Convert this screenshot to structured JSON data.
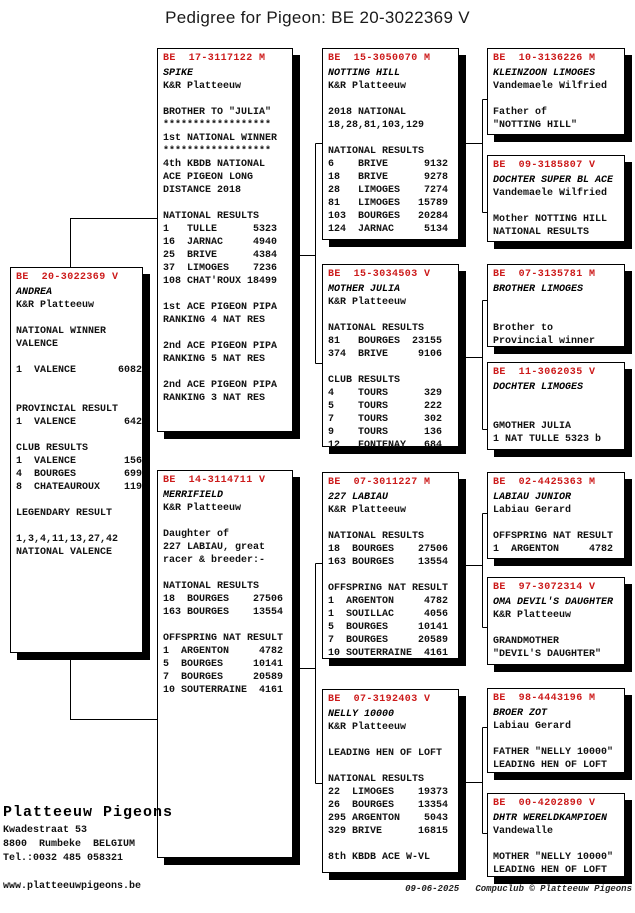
{
  "title": "Pedigree for Pigeon: BE  20-3022369 V",
  "colors": {
    "ring_red": "#cc1a1a",
    "line": "#000000",
    "shadow": "#000000"
  },
  "boxes": {
    "subject": {
      "ring": "BE  20-3022369 V",
      "name": "ANDREA",
      "body": "K&R Platteeuw\n\nNATIONAL WINNER\nVALENCE\n\n1  VALENCE       6082\n\n\nPROVINCIAL RESULT\n1  VALENCE        642\n\nCLUB RESULTS\n1  VALENCE        156\n4  BOURGES        699\n8  CHATEAUROUX    119\n\nLEGENDARY RESULT\n\n1,3,4,11,13,27,42\nNATIONAL VALENCE"
    },
    "sire": {
      "ring": "BE  17-3117122 M",
      "name": "SPIKE",
      "body": "K&R Platteeuw\n\nBROTHER TO \"JULIA\"\n******************\n1st NATIONAL WINNER\n******************\n4th KBDB NATIONAL\nACE PIGEON LONG\nDISTANCE 2018\n\nNATIONAL RESULTS\n1   TULLE      5323\n16  JARNAC     4940\n25  BRIVE      4384\n37  LIMOGES    7236\n108 CHAT'ROUX 18499\n\n1st ACE PIGEON PIPA\nRANKING 4 NAT RES\n\n2nd ACE PIGEON PIPA\nRANKING 5 NAT RES\n\n2nd ACE PIGEON PIPA\nRANKING 3 NAT RES"
    },
    "dam": {
      "ring": "BE  14-3114711 V",
      "name": "MERRIFIELD",
      "body": "K&R Platteeuw\n\nDaughter of\n227 LABIAU, great\nracer & breeder:-\n\nNATIONAL RESULTS\n18  BOURGES    27506\n163 BOURGES    13554\n\nOFFSPRING NAT RESULT\n1  ARGENTON     4782\n5  BOURGES     10141\n7  BOURGES     20589\n10 SOUTERRAINE  4161"
    },
    "ss": {
      "ring": "BE  15-3050070 M",
      "name": "NOTTING HILL",
      "body": "K&R Platteeuw\n\n2018 NATIONAL\n18,28,81,103,129\n\nNATIONAL RESULTS\n6    BRIVE      9132\n18   BRIVE      9278\n28   LIMOGES    7274\n81   LIMOGES   15789\n103  BOURGES   20284\n124  JARNAC     5134"
    },
    "sd": {
      "ring": "BE  15-3034503 V",
      "name": "MOTHER JULIA",
      "body": "K&R Platteeuw\n\nNATIONAL RESULTS\n81   BOURGES  23155\n374  BRIVE     9106\n\nCLUB RESULTS\n4    TOURS      329\n5    TOURS      222\n7    TOURS      302\n9    TOURS      136\n12   FONTENAY   684"
    },
    "ds": {
      "ring": "BE  07-3011227 M",
      "name": "227 LABIAU",
      "body": "K&R Platteeuw\n\nNATIONAL RESULTS\n18  BOURGES    27506\n163 BOURGES    13554\n\nOFFSPRING NAT RESULT\n1  ARGENTON     4782\n1  SOUILLAC     4056\n5  BOURGES     10141\n7  BOURGES     20589\n10 SOUTERRAINE  4161"
    },
    "dd": {
      "ring": "BE  07-3192403 V",
      "name": "NELLY 10000",
      "body": "K&R Platteeuw\n\nLEADING HEN OF LOFT\n\nNATIONAL RESULTS\n22  LIMOGES    19373\n26  BOURGES    13354\n295 ARGENTON    5043\n329 BRIVE      16815\n\n8th KBDB ACE W-VL"
    },
    "sss": {
      "ring": "BE  10-3136226 M",
      "name": "KLEINZOON LIMOGES",
      "body": "Vandemaele Wilfried\n\nFather of\n\"NOTTING HILL\""
    },
    "ssd": {
      "ring": "BE  09-3185807 V",
      "name": "DOCHTER SUPER BL ACE",
      "body": "Vandemaele Wilfried\n\nMother NOTTING HILL\nNATIONAL RESULTS"
    },
    "sds": {
      "ring": "BE  07-3135781 M",
      "name": "BROTHER LIMOGES",
      "body": "\n\nBrother to\nProvincial winner"
    },
    "sdd": {
      "ring": "BE  11-3062035 V",
      "name": "DOCHTER LIMOGES",
      "body": "\n\nGMOTHER JULIA\n1 NAT TULLE 5323 b"
    },
    "dss": {
      "ring": "BE  02-4425363 M",
      "name": "LABIAU JUNIOR",
      "body": "Labiau Gerard\n\nOFFSPRING NAT RESULT\n1  ARGENTON     4782"
    },
    "dsd": {
      "ring": "BE  97-3072314 V",
      "name": "OMA DEVIL'S DAUGHTER",
      "body": "K&R Platteeuw\n\nGRANDMOTHER\n\"DEVIL'S DAUGHTER\""
    },
    "dds": {
      "ring": "BE  98-4443196 M",
      "name": "BROER ZOT",
      "body": "Labiau Gerard\n\nFATHER \"NELLY 10000\"\nLEADING HEN OF LOFT"
    },
    "ddd": {
      "ring": "BE  00-4202890 V",
      "name": "DHTR WERELDKAMPIOEN",
      "body": "Vandewalle\n\nMOTHER \"NELLY 10000\"\nLEADING HEN OF LOFT"
    }
  },
  "loft": {
    "name": "Platteeuw Pigeons",
    "address": "Kwadestraat 53\n8800  Rumbeke  BELGIUM\nTel.:0032 485 058321\n\nwww.platteeuwpigeons.be"
  },
  "credit": {
    "date": "09-06-2025",
    "text": "Compuclub © Platteeuw Pigeons"
  }
}
